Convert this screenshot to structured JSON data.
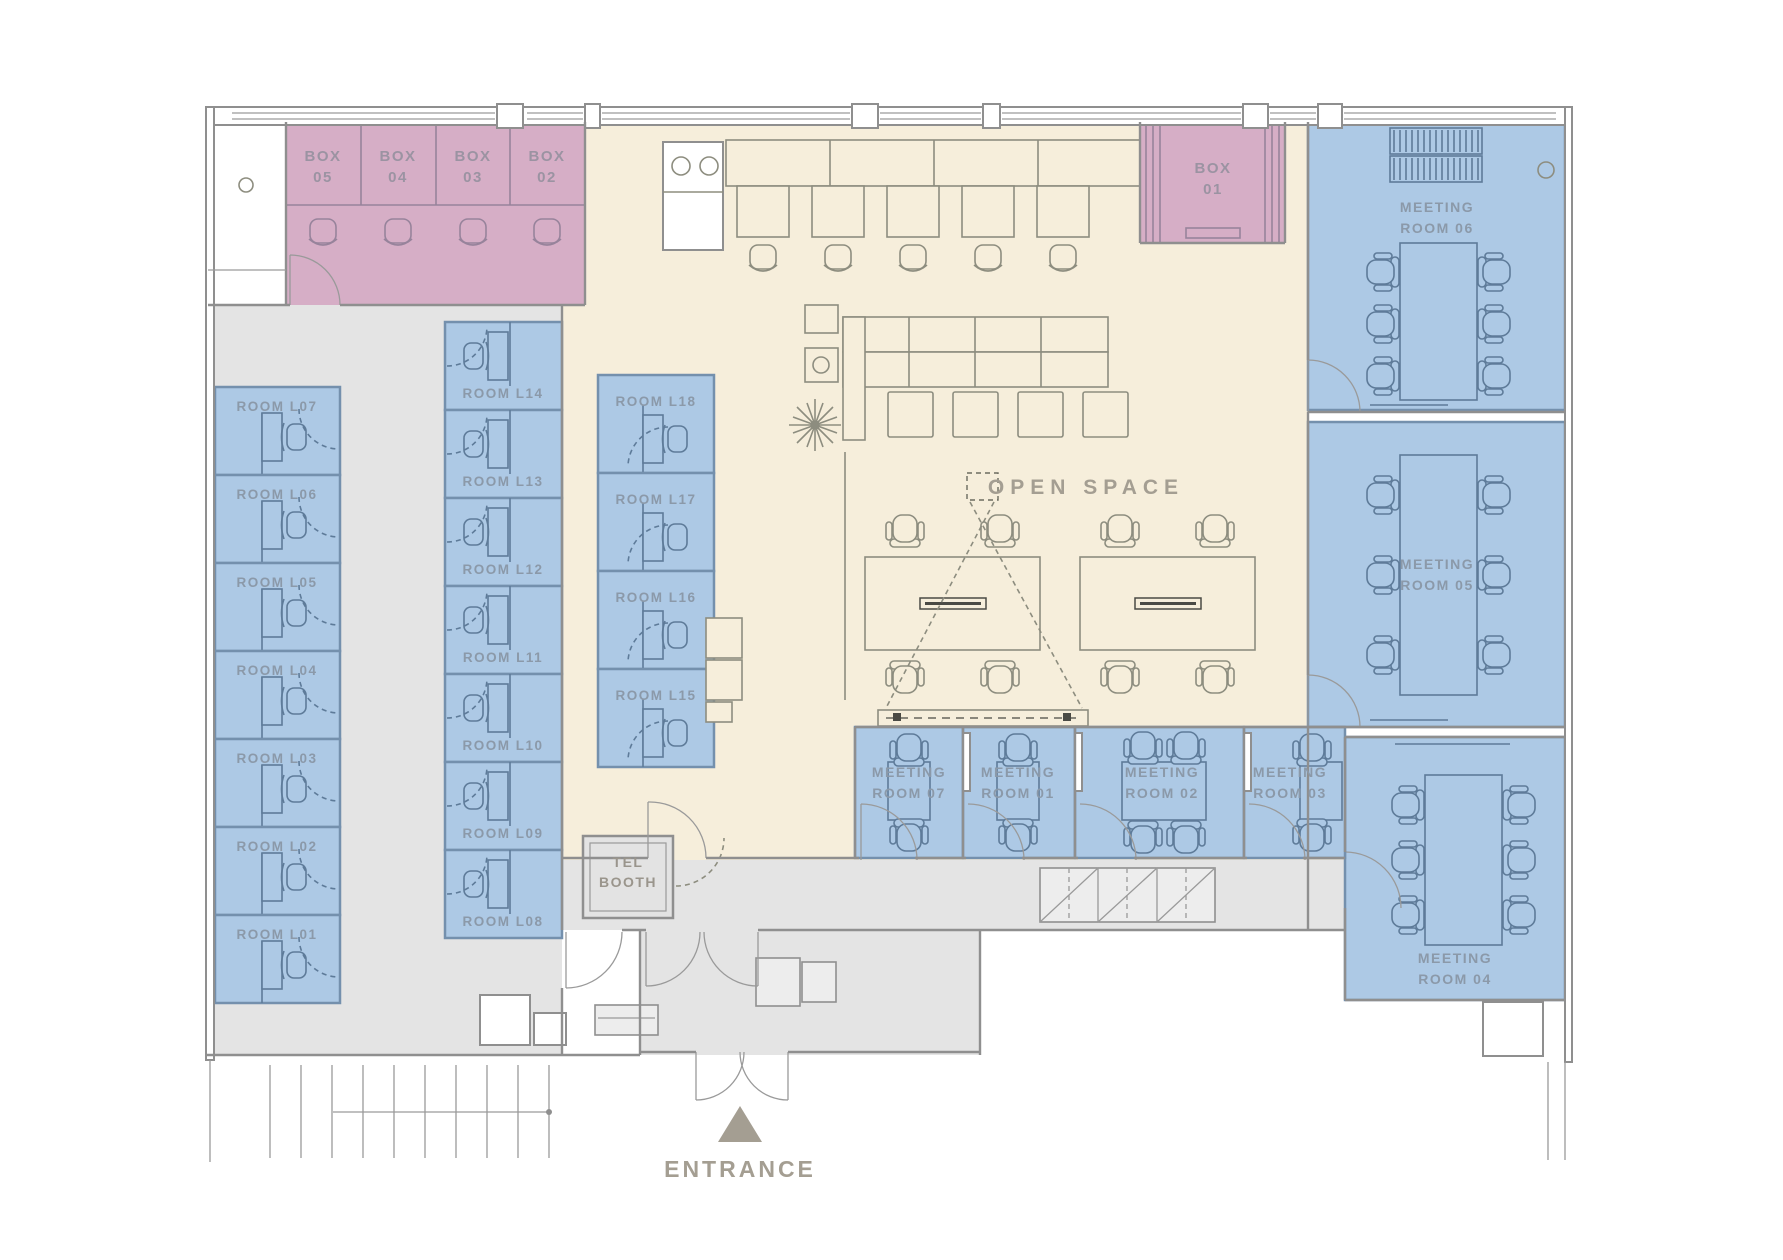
{
  "plan_title": "Office floor plan",
  "colors": {
    "room_blue": "#adc9e5",
    "box_pink": "#d6aec6",
    "floor_cream": "#f6eedb",
    "corridor_gray": "#e4e4e4",
    "label_tan": "#a49e92",
    "label_blue_gray": "#8b99a9"
  },
  "box_row": [
    {
      "t": "BOX",
      "n": "05"
    },
    {
      "t": "BOX",
      "n": "04"
    },
    {
      "t": "BOX",
      "n": "03"
    },
    {
      "t": "BOX",
      "n": "02"
    }
  ],
  "box01": {
    "t": "BOX",
    "n": "01"
  },
  "left_rooms": [
    "ROOM L07",
    "ROOM L06",
    "ROOM L05",
    "ROOM L04",
    "ROOM L03",
    "ROOM L02",
    "ROOM L01"
  ],
  "mid_rooms": [
    "ROOM L14",
    "ROOM L13",
    "ROOM L12",
    "ROOM L11",
    "ROOM L10",
    "ROOM L09",
    "ROOM L08"
  ],
  "right_rooms": [
    "ROOM L18",
    "ROOM L17",
    "ROOM L16",
    "ROOM L15"
  ],
  "meeting": {
    "m06": {
      "a": "MEETING",
      "b": "ROOM 06"
    },
    "m05": {
      "a": "MEETING",
      "b": "ROOM 05"
    },
    "m04": {
      "a": "MEETING",
      "b": "ROOM 04"
    },
    "m07": {
      "a": "MEETING",
      "b": "ROOM 07"
    },
    "m01": {
      "a": "MEETING",
      "b": "ROOM 01"
    },
    "m02": {
      "a": "MEETING",
      "b": "ROOM 02"
    },
    "m03": {
      "a": "MEETING",
      "b": "ROOM 03"
    }
  },
  "open_space": "OPEN SPACE",
  "tel_booth": {
    "a": "TEL",
    "b": "BOOTH"
  },
  "entrance": "ENTRANCE"
}
